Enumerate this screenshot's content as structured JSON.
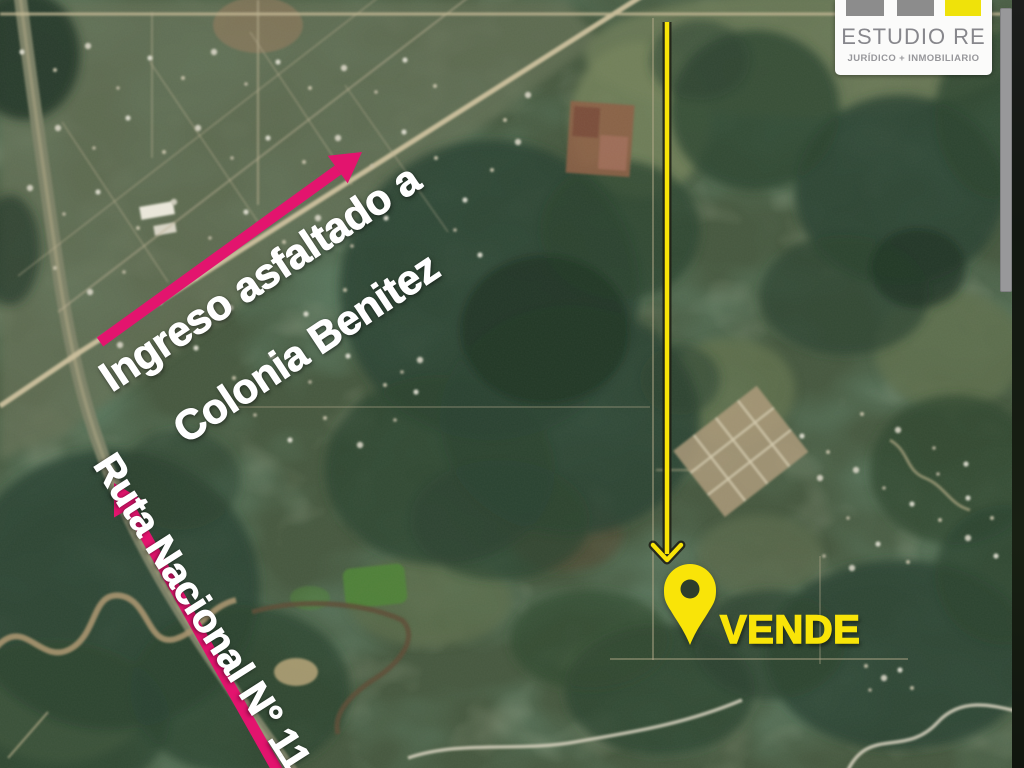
{
  "annotations": {
    "entry_road_label": {
      "line1": "Ingreso asfaltado a",
      "line2": "Colonia Benitez"
    },
    "highway_label": "Ruta Nacional N° 11",
    "sale_label": "VENDE"
  },
  "logo": {
    "title": "ESTUDIO RE",
    "subtitle": "JURÍDICO + INMOBILIARIO"
  },
  "colors": {
    "arrow_pink": "#e3146e",
    "annotation_yellow": "#f9e408",
    "label_white": "#ffffff",
    "logo_gray": "#8c8c8c",
    "logo_yellow": "#efe20a",
    "logo_text_gray": "#87878c"
  }
}
